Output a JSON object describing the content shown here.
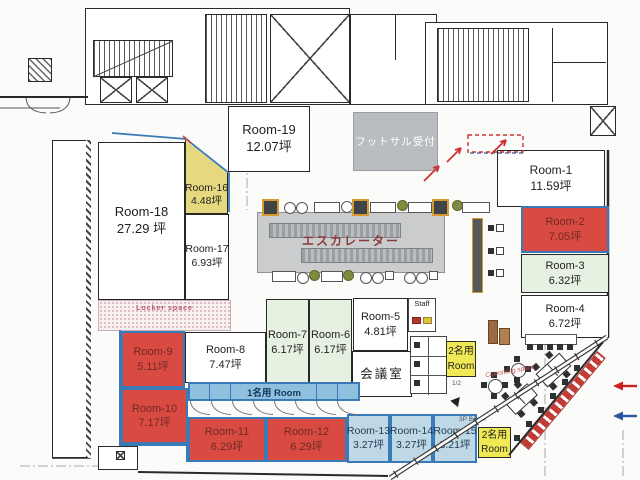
{
  "rooms": [
    {
      "name": "Room-1",
      "size": "11.59坪"
    },
    {
      "name": "Room-2",
      "size": "7.05坪"
    },
    {
      "name": "Room-3",
      "size": "6.32坪"
    },
    {
      "name": "Room-4",
      "size": "6.72坪"
    },
    {
      "name": "Room-5",
      "size": "4.81坪"
    },
    {
      "name": "Room-6",
      "size": "6.17坪"
    },
    {
      "name": "Room-7",
      "size": "6.17坪"
    },
    {
      "name": "Room-8",
      "size": "7.47坪"
    },
    {
      "name": "Room-9",
      "size": "5.11坪"
    },
    {
      "name": "Room-10",
      "size": "7.17坪"
    },
    {
      "name": "Room-11",
      "size": "6.29坪"
    },
    {
      "name": "Room-12",
      "size": "6.29坪"
    },
    {
      "name": "Room-13",
      "size": "3.27坪"
    },
    {
      "name": "Room-14",
      "size": "3.27坪"
    },
    {
      "name": "Room-15",
      "size": "3.21坪"
    },
    {
      "name": "Room-16",
      "size": "4.48坪"
    },
    {
      "name": "Room-17",
      "size": "6.93坪"
    },
    {
      "name": "Room-18",
      "size": "27.29 坪"
    },
    {
      "name": "Room-19",
      "size": "12.07坪"
    }
  ],
  "areas": {
    "futsal_reception": "フットサル受付",
    "escalator": "エスカレーター",
    "meeting_room": "会議室",
    "staff": "Staff",
    "locker_space": "Locker space",
    "booth_row_label": "1名用 Room",
    "two_person_room_line1": "2名用",
    "two_person_room_line2": "Room",
    "fraction_label": "1/2",
    "bp_booth_label": "3P Booth",
    "coworking_label": "Coworking space"
  },
  "colors": {
    "red": "#d94a43",
    "yellow": "#f0e855",
    "yellow_muted": "#e6d87e",
    "green": "#e7f1e2",
    "light_blue": "#bfd8e6",
    "booth_blue": "#8fc0dd",
    "border_blue": "#3a7ab8",
    "gray_box": "#b9bdbf",
    "escalator_gray": "#caccce",
    "red_text": "#6e2a24",
    "blue_text": "#1f3a52"
  }
}
